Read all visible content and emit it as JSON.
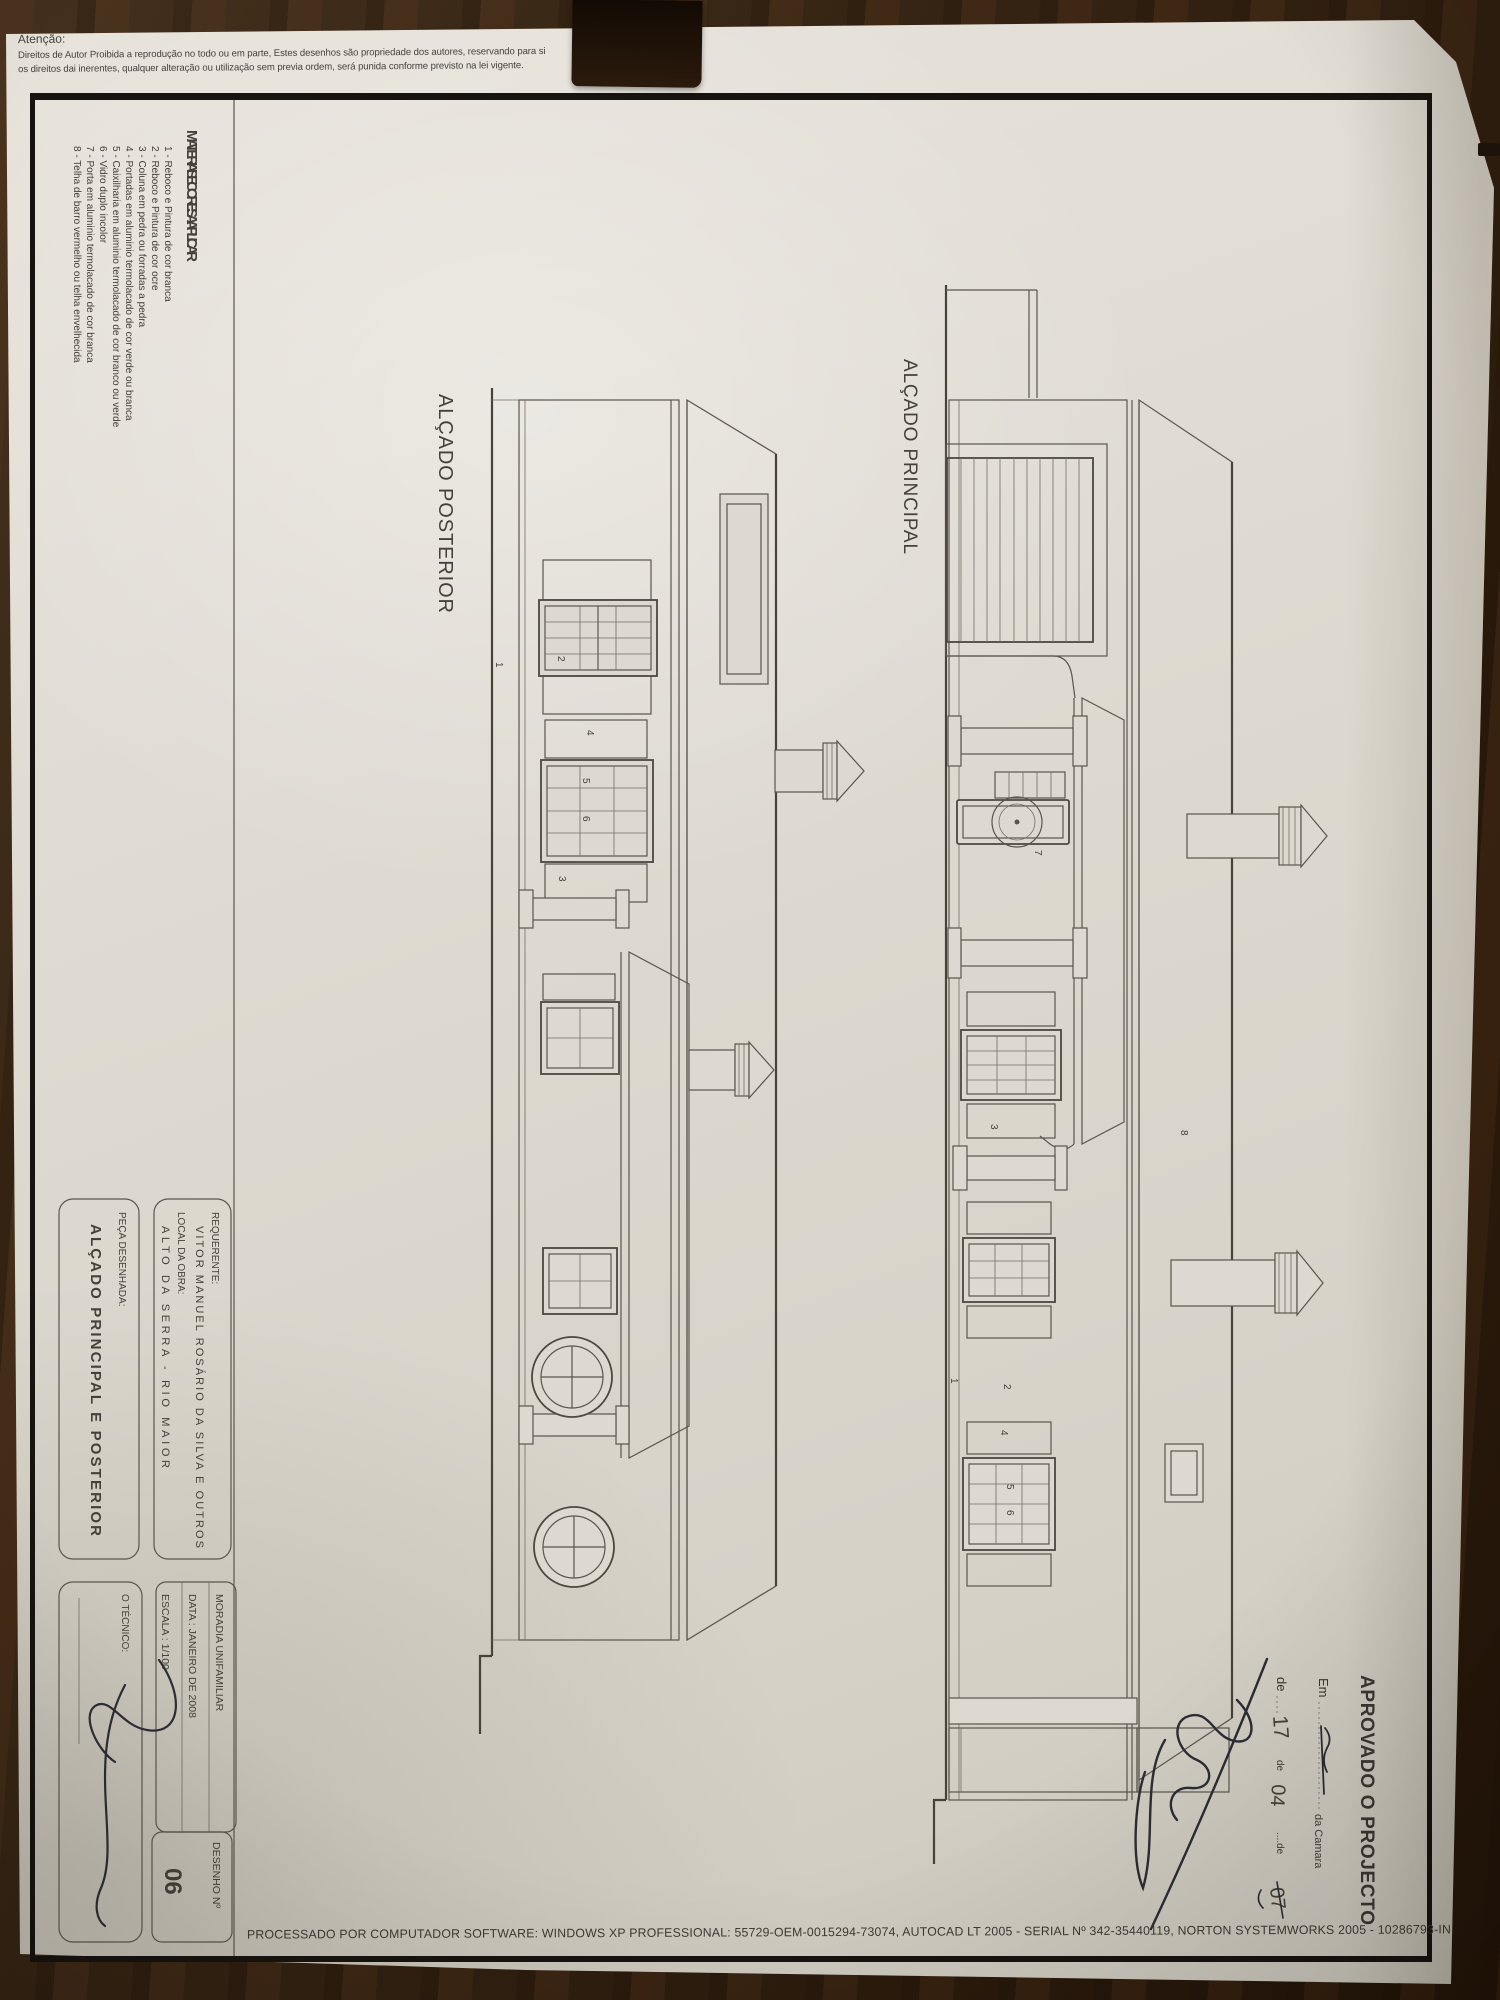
{
  "warning": {
    "title": "Atenção:",
    "line1": "Direitos de Autor Proibida a reprodução no todo ou em parte, Estes desenhos são propriedade dos autores, reservando para si",
    "line2": "os direitos dai inerentes, qualquer alteração ou utilização sem previa ordem, será punida conforme previsto na lei vigente."
  },
  "drawings": {
    "posterior_title": "ALÇADO POSTERIOR",
    "principal_title": "ALÇADO PRINCIPAL"
  },
  "materials": {
    "title": "MATERIAIS E CORES A APLICAR",
    "items": [
      "1 - Reboco e Pintura de cor branca",
      "2 - Reboco e Pintura de cor ocre",
      "3 - Coluna em pedra ou forradas a pedra",
      "4 - Portadas em aluminio termolacado de cor verde ou branca",
      "5 - Caixilharia em aluminio termolacado de cor branco ou verde",
      "6 - Vidro duplo incolor",
      "7 - Porta em aluminio termolacado de cor branca",
      "8 - Telha de barro vermelho ou telha envelhecida"
    ]
  },
  "callouts": {
    "c1": "1",
    "c2": "2",
    "c3": "3",
    "c4": "4",
    "c5": "5",
    "c6": "6",
    "c7": "7",
    "c8": "8"
  },
  "title_block": {
    "requerente_label": "REQUERENTE:",
    "requerente": "VITOR MANUEL ROSÁRIO DA SILVA E OUTROS",
    "local_label": "LOCAL DA OBRA:",
    "local": "ALTO DA SERRA - RIO MAIOR",
    "moradia": "MORADIA UNIFAMILIAR",
    "data": "DATA : JANEIRO DE 2008",
    "escala": "ESCALA : 1/100",
    "peca_label": "PEÇA DESENHADA:",
    "peca": "ALÇADO PRINCIPAL E POSTERIOR",
    "tecnico_label": "O TÉCNICO:",
    "desenho_label": "DESENHO  Nº",
    "desenho_numero": "06"
  },
  "stamp": {
    "title": "APROVADO O PROJECTO",
    "em": "Em",
    "camara": "da Camara",
    "de1": "de",
    "dia": "17",
    "de2": "de",
    "mes": "04",
    "de3": "....de",
    "ano": "07"
  },
  "footer": {
    "processado": "PROCESSADO POR COMPUTADOR SOFTWARE: WINDOWS XP PROFESSIONAL:  55729-OEM-0015294-73074, AUTOCAD LT 2005 - SERIAL Nº  342-35440119, NORTON SYSTEMWORKS 2005 - 10286793-IN"
  }
}
